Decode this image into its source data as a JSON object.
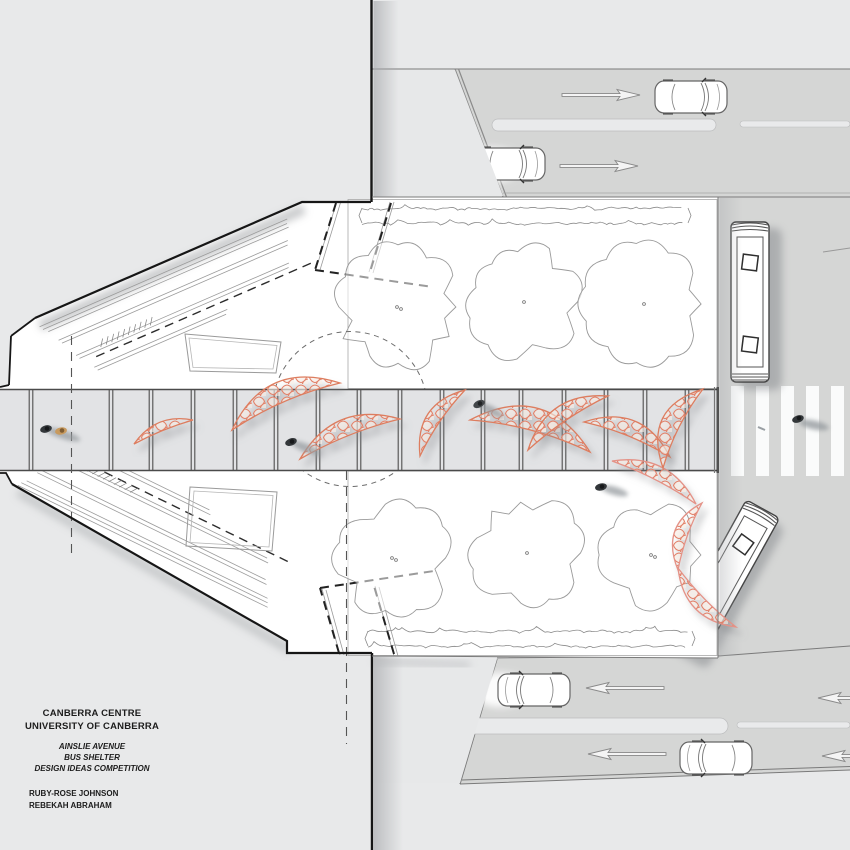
{
  "title_block": {
    "site_line1": "CANBERRA CENTRE",
    "site_line2": "UNIVERSITY OF CANBERRA",
    "project_line1": "AINSLIE AVENUE",
    "project_line2": "BUS SHELTER",
    "project_line3": "DESIGN IDEAS COMPETITION",
    "author_line1": "RUBY-ROSE JOHNSON",
    "author_line2": "REBEKAH ABRAHAM"
  },
  "colors": {
    "background": "#e8e9ea",
    "road": "#d5d6d5",
    "site": "#ffffff",
    "walkway": "#e2e3e5",
    "canopy_accent": "#e08a6e",
    "ink": "#1c1c1c"
  }
}
